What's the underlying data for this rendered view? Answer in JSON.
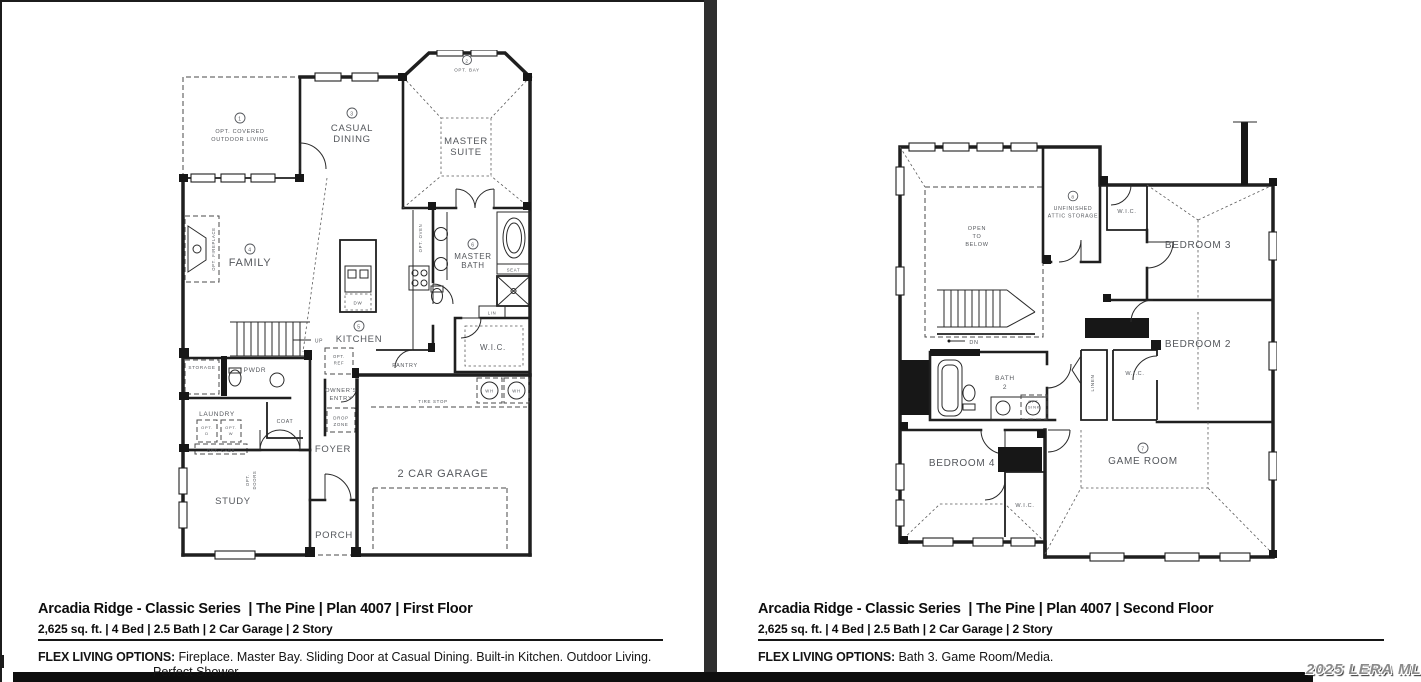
{
  "watermark": "2025 LERA MLS",
  "panels": [
    {
      "title": "Arcadia Ridge - Classic Series  | The Pine | Plan 4007 | First Floor",
      "specs": "2,625 sq. ft. | 4 Bed | 2.5 Bath | 2 Car Garage | 2 Story",
      "flex_label": "FLEX LIVING OPTIONS:",
      "flex_lines": [
        "Fireplace. Master Bay. Sliding Door at Casual Dining. Built-in Kitchen. Outdoor Living.",
        "Perfect Shower."
      ]
    },
    {
      "title": "Arcadia Ridge - Classic Series  | The Pine | Plan 4007 | Second Floor",
      "specs": "2,625 sq. ft. | 4 Bed | 2.5 Bath | 2 Car Garage | 2 Story",
      "flex_label": "FLEX LIVING OPTIONS:",
      "flex_lines": [
        "Bath 3. Game Room/Media."
      ]
    }
  ],
  "first_floor": {
    "callouts": {
      "outdoor": "1",
      "bay": "2",
      "dining": "3",
      "family": "4",
      "kitchen": "5",
      "bath": "6"
    },
    "labels": {
      "opt_bay": "OPT. BAY",
      "outdoor1": "OPT. COVERED",
      "outdoor2": "OUTDOOR LIVING",
      "dining1": "CASUAL",
      "dining2": "DINING",
      "suite1": "MASTER",
      "suite2": "SUITE",
      "family": "FAMILY",
      "fireplace": "OPT. FIREPLACE",
      "kitchen": "KITCHEN",
      "opt_oven": "OPT. OVEN",
      "dw": "DW",
      "bath1": "MASTER",
      "bath2": "BATH",
      "seat": "SEAT",
      "lin": "LIN",
      "wic": "W.I.C.",
      "up": "UP",
      "storage": "STORAGE",
      "pwdr": "PWDR",
      "laundry": "LAUNDRY",
      "opt_d1": "OPT.",
      "opt_d2": "D",
      "opt_w1": "OPT.",
      "opt_w2": "W",
      "opt_cabs": "OPT. CABS",
      "coat": "COAT",
      "foyer": "FOYER",
      "owners1": "OWNER'S",
      "owners2": "ENTRY",
      "opt_ref1": "OPT.",
      "opt_ref2": "REF",
      "pantry": "PANTRY",
      "drop1": "DROP",
      "drop2": "ZONE",
      "tire_stop": "TIRE STOP",
      "wh": "WH",
      "garage": "2 CAR GARAGE",
      "study": "STUDY",
      "opt_doors1": "OPT.",
      "opt_doors2": "DOORS",
      "porch": "PORCH"
    }
  },
  "second_floor": {
    "callouts": {
      "game": "7",
      "attic": "8"
    },
    "labels": {
      "open1": "OPEN",
      "open2": "TO",
      "open3": "BELOW",
      "attic1": "UNFINISHED",
      "attic2": "ATTIC STORAGE",
      "wic_hall": "W.I.C.",
      "bedroom3": "BEDROOM 3",
      "bedroom2": "BEDROOM 2",
      "dn": "DN",
      "bath21": "BATH",
      "bath22": "2",
      "opt_sink1": "OPT.",
      "opt_sink2": "SINK",
      "linen": "LINEN",
      "wic_bed2": "W.I.C.",
      "bedroom4": "BEDROOM 4",
      "wic_bed4": "W.I.C.",
      "game": "GAME ROOM"
    }
  }
}
